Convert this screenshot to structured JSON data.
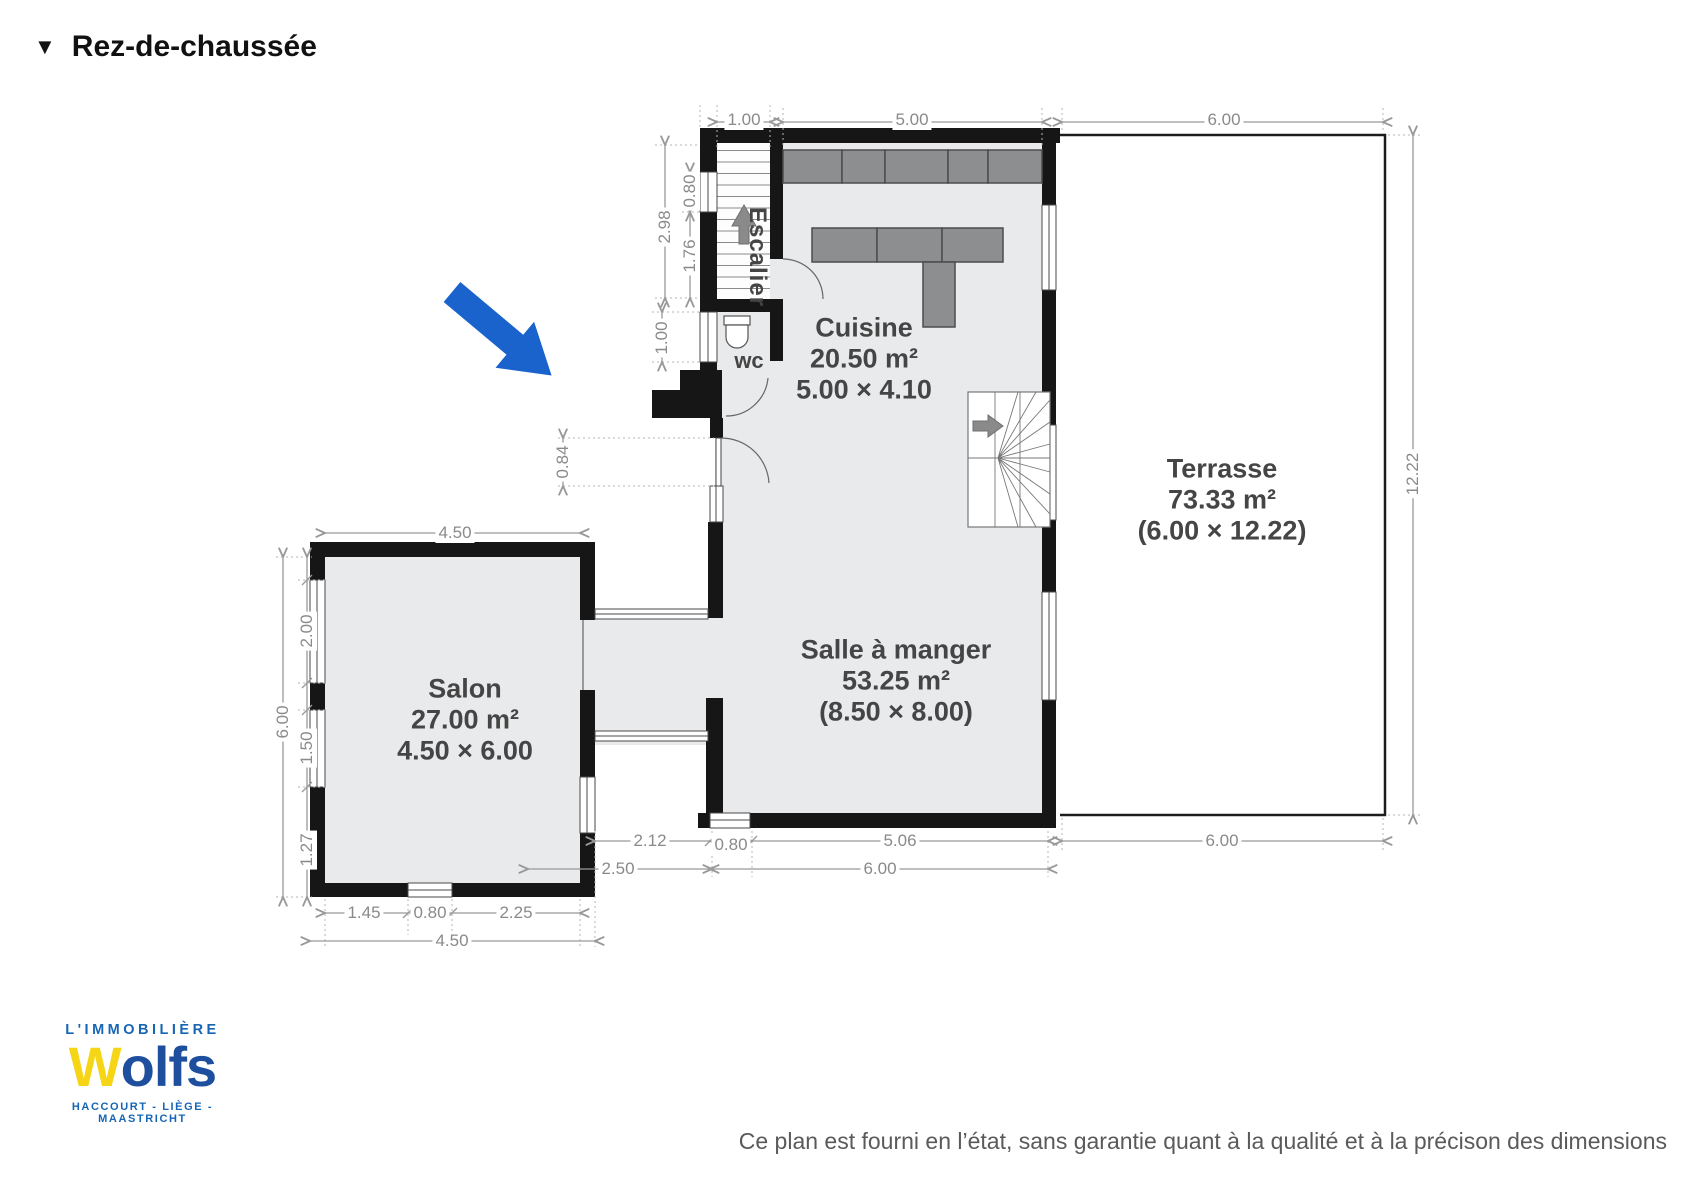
{
  "title": {
    "icon": "▼",
    "text": "Rez-de-chaussée"
  },
  "rooms": {
    "escalier": {
      "name": "Escalier"
    },
    "wc": {
      "name": "wc"
    },
    "cuisine": {
      "name": "Cuisine",
      "area": "20.50 m²",
      "size": "5.00 × 4.10"
    },
    "salle_a_manger": {
      "name": "Salle à manger",
      "area": "53.25 m²",
      "size": "(8.50 × 8.00)"
    },
    "salon": {
      "name": "Salon",
      "area": "27.00 m²",
      "size": "4.50 × 6.00"
    },
    "terrasse": {
      "name": "Terrasse",
      "area": "73.33 m²",
      "size": "(6.00 × 12.22)"
    }
  },
  "dims": {
    "top_stairs": "1.00",
    "top_kitchen": "5.00",
    "top_terrace": "6.00",
    "esc_total": "2.98",
    "esc_window": "0.80",
    "esc_lower": "1.76",
    "wc_window": "1.00",
    "entry_door": "0.84",
    "salon_top": "4.50",
    "salon_left_total": "6.00",
    "salon_win_top": "2.00",
    "salon_win_mid": "1.50",
    "salon_win_bot": "1.27",
    "salon_b1": "1.45",
    "salon_b2": "0.80",
    "salon_b3": "2.25",
    "salon_b_total": "4.50",
    "corridor_inner": "2.12",
    "dining_window": "0.80",
    "dining_bottom": "5.06",
    "terrace_bottom": "6.00",
    "corridor_outer": "2.50",
    "dining_total": "6.00",
    "terrace_right": "12.22"
  },
  "logo": {
    "tagline": "L'IMMOBILIÈRE",
    "brand_w": "W",
    "brand_rest": "olfs",
    "cities": "HACCOURT - LIÈGE - MAASTRICHT"
  },
  "footer": {
    "disclaimer": "Ce plan est fourni en l’état, sans garantie quant à la qualité et à la précison des dimensions"
  },
  "colors": {
    "entrance_arrow": "#1a63cc",
    "wall": "#161616",
    "logo_blue": "#1766b5",
    "brand_blue": "#1d4f9e",
    "brand_yellow": "#f5d515"
  }
}
